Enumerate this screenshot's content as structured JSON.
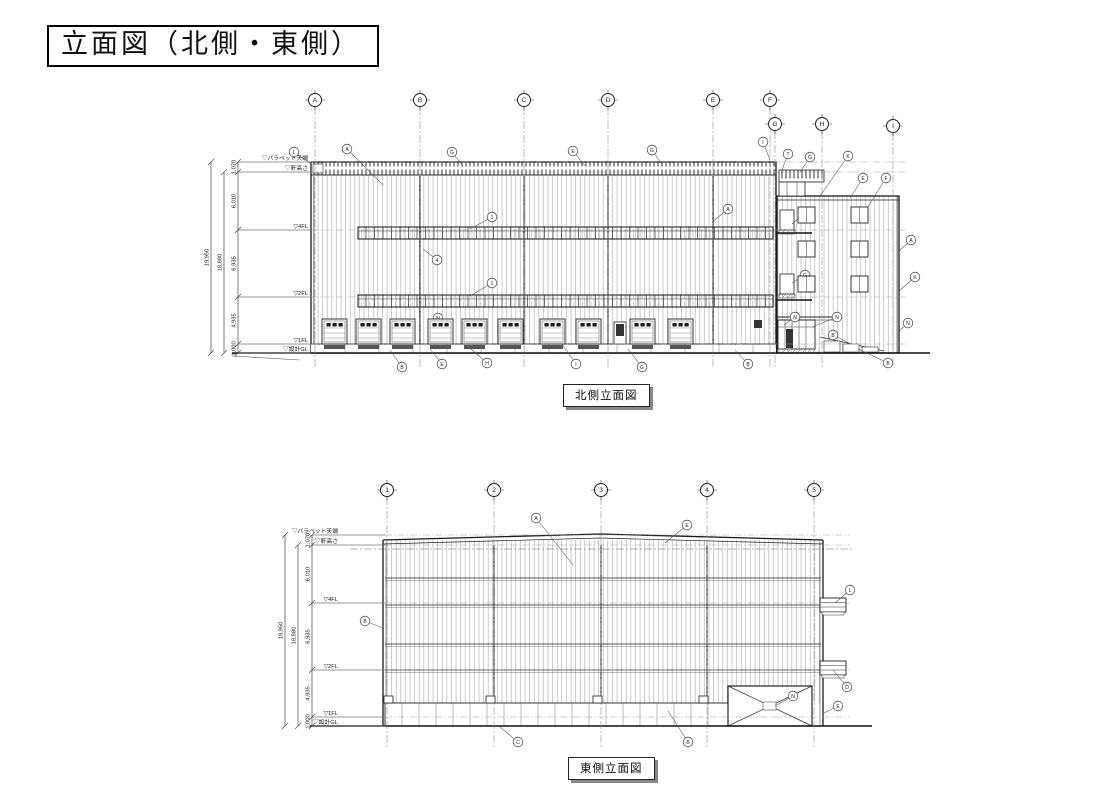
{
  "title": "立面図（北側・東側）",
  "colors": {
    "line": "#222222",
    "light_line": "#777777",
    "accent_dark": "#111111",
    "shadow": "#888888"
  },
  "north": {
    "caption": "北側立面図",
    "grid": [
      {
        "label": "A",
        "x": 315,
        "y": 100
      },
      {
        "label": "B",
        "x": 420,
        "y": 100
      },
      {
        "label": "C",
        "x": 524,
        "y": 100
      },
      {
        "label": "D",
        "x": 608,
        "y": 100
      },
      {
        "label": "E",
        "x": 713,
        "y": 100
      },
      {
        "label": "F",
        "x": 770,
        "y": 100
      },
      {
        "label": "G",
        "x": 775,
        "y": 124
      },
      {
        "label": "H",
        "x": 822,
        "y": 124
      },
      {
        "label": "I",
        "x": 893,
        "y": 126
      }
    ],
    "grid_bottom": 368,
    "levels": [
      {
        "label": "▽パラペット天端",
        "y": 162
      },
      {
        "label": "▽軒高さ",
        "y": 172
      },
      {
        "label": "▽4FL",
        "y": 230
      },
      {
        "label": "▽2FL",
        "y": 297
      },
      {
        "label": "▽1FL",
        "y": 344
      },
      {
        "label": "▽設計GL",
        "y": 353
      }
    ],
    "dims": [
      "1,070",
      "6,010",
      "6,935",
      "4,935",
      "1,000"
    ],
    "overall": [
      {
        "v": "19,950",
        "x": 211,
        "from": 0
      },
      {
        "v": "18,880",
        "x": 224,
        "from": 1
      }
    ],
    "layout": {
      "inner_x": 238,
      "label_x": 308,
      "line_x2": 311,
      "dash_x2": 908
    },
    "doors": [
      322,
      356,
      390,
      428,
      462,
      498,
      540,
      576,
      630,
      668
    ],
    "annex_window_cols": [
      798,
      851
    ],
    "annex_window_rows": [
      207,
      241,
      276
    ],
    "annotations": [
      {
        "t": "L",
        "x": 294,
        "y": 152,
        "ex": 310,
        "ey": 163
      },
      {
        "t": "A",
        "x": 347,
        "y": 149,
        "ex": 383,
        "ey": 185
      },
      {
        "t": "G",
        "x": 452,
        "y": 152,
        "ex": 463,
        "ey": 166
      },
      {
        "t": "E",
        "x": 573,
        "y": 151,
        "ex": 585,
        "ey": 166
      },
      {
        "t": "G",
        "x": 652,
        "y": 150,
        "ex": 663,
        "ey": 166
      },
      {
        "t": "I",
        "x": 763,
        "y": 142,
        "ex": 770,
        "ey": 160
      },
      {
        "t": "T",
        "x": 788,
        "y": 154,
        "ex": 782,
        "ey": 170
      },
      {
        "t": "G",
        "x": 810,
        "y": 157,
        "ex": 800,
        "ey": 172
      },
      {
        "t": "K",
        "x": 848,
        "y": 156,
        "ex": 820,
        "ey": 196
      },
      {
        "t": "E",
        "x": 863,
        "y": 178,
        "ex": 850,
        "ey": 198
      },
      {
        "t": "F",
        "x": 886,
        "y": 178,
        "ex": 866,
        "ey": 210
      },
      {
        "t": "1",
        "x": 492,
        "y": 217,
        "ex": 470,
        "ey": 229
      },
      {
        "t": "A",
        "x": 728,
        "y": 209,
        "ex": 712,
        "ey": 222
      },
      {
        "t": "4",
        "x": 437,
        "y": 260,
        "ex": 423,
        "ey": 249
      },
      {
        "t": "1",
        "x": 492,
        "y": 283,
        "ex": 470,
        "ey": 296
      },
      {
        "t": "G",
        "x": 805,
        "y": 213,
        "ex": 792,
        "ey": 224
      },
      {
        "t": "G",
        "x": 805,
        "y": 275,
        "ex": 792,
        "ey": 283
      },
      {
        "t": "A",
        "x": 911,
        "y": 240,
        "ex": 899,
        "ey": 251
      },
      {
        "t": "K",
        "x": 915,
        "y": 277,
        "ex": 899,
        "ey": 291
      },
      {
        "t": "N",
        "x": 908,
        "y": 323,
        "ex": 899,
        "ey": 331
      },
      {
        "t": "B",
        "x": 888,
        "y": 363,
        "ex": 858,
        "ey": 349
      },
      {
        "t": "N",
        "x": 795,
        "y": 317,
        "ex": 784,
        "ey": 325
      },
      {
        "t": "N",
        "x": 837,
        "y": 317,
        "ex": 812,
        "ey": 327
      },
      {
        "t": "B",
        "x": 833,
        "y": 335,
        "ex": 849,
        "ey": 343
      },
      {
        "t": "N",
        "x": 438,
        "y": 318,
        "ex": 430,
        "ey": 327
      },
      {
        "t": "B",
        "x": 402,
        "y": 367,
        "ex": 390,
        "ey": 350
      },
      {
        "t": "E",
        "x": 442,
        "y": 364,
        "ex": 430,
        "ey": 349
      },
      {
        "t": "H",
        "x": 487,
        "y": 363,
        "ex": 471,
        "ey": 349
      },
      {
        "t": "I",
        "x": 576,
        "y": 364,
        "ex": 560,
        "ey": 341
      },
      {
        "t": "G",
        "x": 642,
        "y": 367,
        "ex": 628,
        "ey": 349
      },
      {
        "t": "B",
        "x": 748,
        "y": 364,
        "ex": 735,
        "ey": 350
      }
    ]
  },
  "east": {
    "caption": "東側立面図",
    "grid": [
      {
        "label": "1",
        "x": 387,
        "y": 490
      },
      {
        "label": "2",
        "x": 494,
        "y": 490
      },
      {
        "label": "3",
        "x": 601,
        "y": 490
      },
      {
        "label": "4",
        "x": 707,
        "y": 490
      },
      {
        "label": "5",
        "x": 814,
        "y": 490
      }
    ],
    "grid_bottom": 748,
    "levels": [
      {
        "label": "▽パラペット天端",
        "y": 535
      },
      {
        "label": "▽軒高さ",
        "y": 545
      },
      {
        "label": "▽4FL",
        "y": 603
      },
      {
        "label": "▽2FL",
        "y": 670
      },
      {
        "label": "▽1FL",
        "y": 717
      },
      {
        "label": "▽設計GL",
        "y": 726
      }
    ],
    "dims": [
      "1,070",
      "6,010",
      "6,935",
      "4,935",
      "1,000"
    ],
    "overall": [
      {
        "v": "19,950",
        "x": 285,
        "from": 0
      },
      {
        "v": "18,880",
        "x": 298,
        "from": 1
      }
    ],
    "layout": {
      "inner_x": 312,
      "label_x": 338,
      "line_x2": 385,
      "dash_x2": 850
    },
    "base_tabs": [
      384,
      486,
      593,
      699
    ],
    "annotations": [
      {
        "t": "A",
        "x": 536,
        "y": 518,
        "ex": 573,
        "ey": 565
      },
      {
        "t": "E",
        "x": 687,
        "y": 525,
        "ex": 665,
        "ey": 543
      },
      {
        "t": "B",
        "x": 365,
        "y": 621,
        "ex": 383,
        "ey": 628
      },
      {
        "t": "L",
        "x": 850,
        "y": 590,
        "ex": 835,
        "ey": 603
      },
      {
        "t": "D",
        "x": 847,
        "y": 687,
        "ex": 833,
        "ey": 670
      },
      {
        "t": "E",
        "x": 838,
        "y": 706,
        "ex": 824,
        "ey": 713
      },
      {
        "t": "N",
        "x": 793,
        "y": 696,
        "ex": 775,
        "ey": 706
      },
      {
        "t": "C",
        "x": 518,
        "y": 742,
        "ex": 500,
        "ey": 727
      },
      {
        "t": "B",
        "x": 688,
        "y": 742,
        "ex": 668,
        "ey": 711
      }
    ]
  }
}
